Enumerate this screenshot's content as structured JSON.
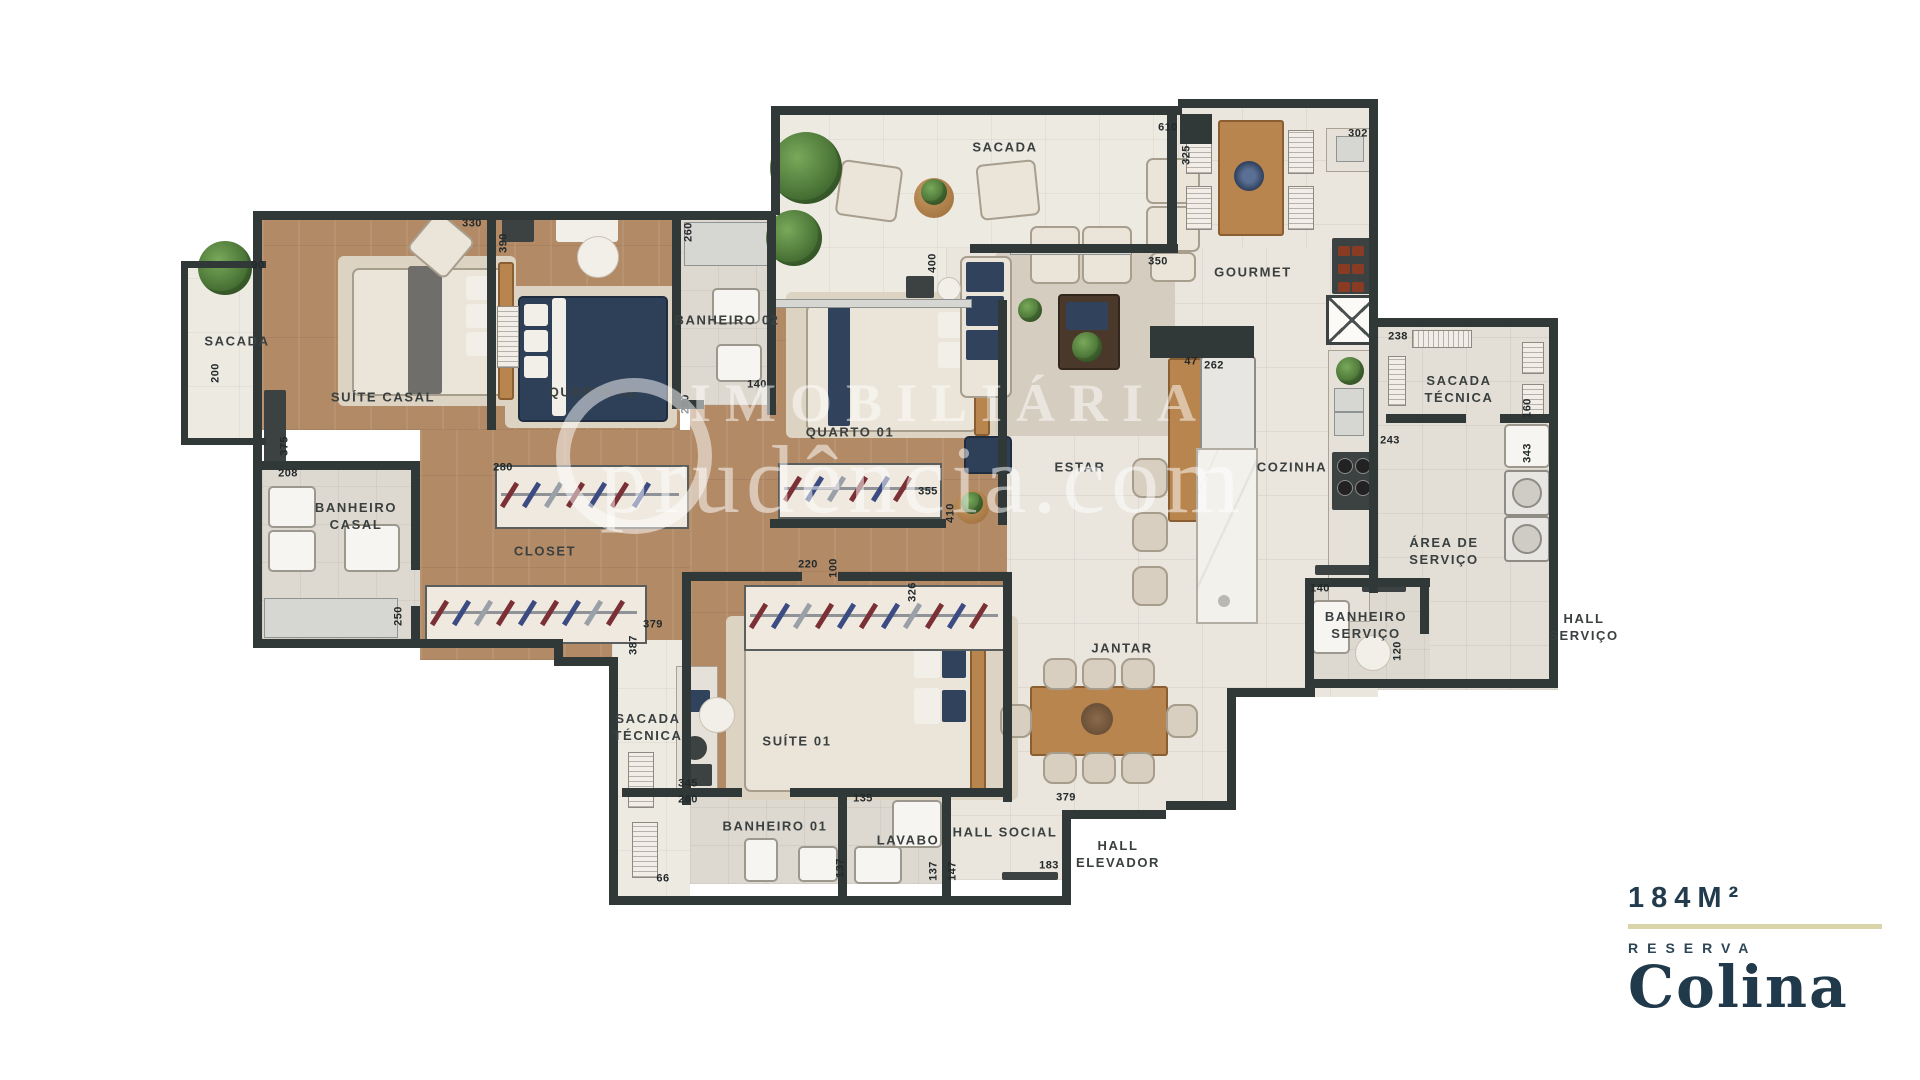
{
  "labels": {
    "rooms": [
      {
        "text": "SACADA",
        "x": 1005,
        "y": 148
      },
      {
        "text": "GOURMET",
        "x": 1253,
        "y": 273
      },
      {
        "text": "SUÍTE CASAL",
        "x": 383,
        "y": 398
      },
      {
        "text": "QUARTO 02",
        "x": 593,
        "y": 393
      },
      {
        "text": "BANHEIRO 02",
        "x": 727,
        "y": 321
      },
      {
        "text": "QUARTO 01",
        "x": 850,
        "y": 433
      },
      {
        "text": "ESTAR",
        "x": 1080,
        "y": 468
      },
      {
        "text": "COZINHA",
        "x": 1292,
        "y": 468
      },
      {
        "text": "SACADA\nTÉCNICA",
        "x": 1459,
        "y": 390
      },
      {
        "text": "ÁREA DE\nSERVIÇO",
        "x": 1444,
        "y": 552
      },
      {
        "text": "BANHEIRO\nSERVIÇO",
        "x": 1366,
        "y": 626
      },
      {
        "text": "HALL\nSERVIÇO",
        "x": 1584,
        "y": 628
      },
      {
        "text": "JANTAR",
        "x": 1122,
        "y": 649
      },
      {
        "text": "HALL SOCIAL",
        "x": 1005,
        "y": 833
      },
      {
        "text": "HALL\nELEVADOR",
        "x": 1118,
        "y": 855
      },
      {
        "text": "LAVABO",
        "x": 908,
        "y": 841
      },
      {
        "text": "BANHEIRO 01",
        "x": 775,
        "y": 827
      },
      {
        "text": "SUÍTE 01",
        "x": 797,
        "y": 742
      },
      {
        "text": "CLOSET",
        "x": 545,
        "y": 552
      },
      {
        "text": "SACADA",
        "x": 237,
        "y": 342
      },
      {
        "text": "SACADA\nTÉCNICA",
        "x": 648,
        "y": 728
      },
      {
        "text": "BANHEIRO\nCASAL",
        "x": 356,
        "y": 517
      }
    ],
    "dims": [
      {
        "v": "90",
        "x": 258,
        "y": 266
      },
      {
        "v": "200",
        "x": 216,
        "y": 373,
        "vert": true
      },
      {
        "v": "330",
        "x": 472,
        "y": 224
      },
      {
        "v": "390",
        "x": 504,
        "y": 243,
        "vert": true
      },
      {
        "v": "260",
        "x": 689,
        "y": 232,
        "vert": true
      },
      {
        "v": "140",
        "x": 757,
        "y": 385
      },
      {
        "v": "290",
        "x": 686,
        "y": 404,
        "vert": true
      },
      {
        "v": "208",
        "x": 288,
        "y": 474
      },
      {
        "v": "375",
        "x": 285,
        "y": 446,
        "vert": true
      },
      {
        "v": "280",
        "x": 503,
        "y": 468
      },
      {
        "v": "250",
        "x": 399,
        "y": 616,
        "vert": true
      },
      {
        "v": "379",
        "x": 653,
        "y": 625
      },
      {
        "v": "387",
        "x": 634,
        "y": 645,
        "vert": true
      },
      {
        "v": "400",
        "x": 933,
        "y": 263,
        "vert": true
      },
      {
        "v": "355",
        "x": 928,
        "y": 492
      },
      {
        "v": "410",
        "x": 951,
        "y": 513,
        "vert": true
      },
      {
        "v": "220",
        "x": 808,
        "y": 565
      },
      {
        "v": "100",
        "x": 834,
        "y": 568,
        "vert": true
      },
      {
        "v": "326",
        "x": 913,
        "y": 592,
        "vert": true
      },
      {
        "v": "610",
        "x": 1168,
        "y": 128
      },
      {
        "v": "325",
        "x": 1187,
        "y": 155,
        "vert": true
      },
      {
        "v": "350",
        "x": 1158,
        "y": 262
      },
      {
        "v": "302",
        "x": 1358,
        "y": 134
      },
      {
        "v": "238",
        "x": 1398,
        "y": 337
      },
      {
        "v": "160",
        "x": 1528,
        "y": 408,
        "vert": true
      },
      {
        "v": "243",
        "x": 1390,
        "y": 441
      },
      {
        "v": "343",
        "x": 1528,
        "y": 453,
        "vert": true
      },
      {
        "v": "262",
        "x": 1214,
        "y": 366
      },
      {
        "v": "47",
        "x": 1191,
        "y": 362
      },
      {
        "v": "140",
        "x": 1320,
        "y": 589
      },
      {
        "v": "120",
        "x": 1398,
        "y": 651,
        "vert": true
      },
      {
        "v": "345",
        "x": 688,
        "y": 784
      },
      {
        "v": "260",
        "x": 688,
        "y": 800
      },
      {
        "v": "66",
        "x": 663,
        "y": 879
      },
      {
        "v": "137",
        "x": 841,
        "y": 868,
        "vert": true
      },
      {
        "v": "135",
        "x": 863,
        "y": 799
      },
      {
        "v": "137",
        "x": 934,
        "y": 871,
        "vert": true
      },
      {
        "v": "147",
        "x": 953,
        "y": 871,
        "vert": true
      },
      {
        "v": "183",
        "x": 1049,
        "y": 866
      },
      {
        "v": "379",
        "x": 1066,
        "y": 798
      }
    ]
  },
  "logo": {
    "area": "184M²",
    "reserva": "RESERVA",
    "name": "Colina"
  },
  "watermark": {
    "line1": "IMOBILIÁRIA",
    "line2": "prudência.com"
  }
}
